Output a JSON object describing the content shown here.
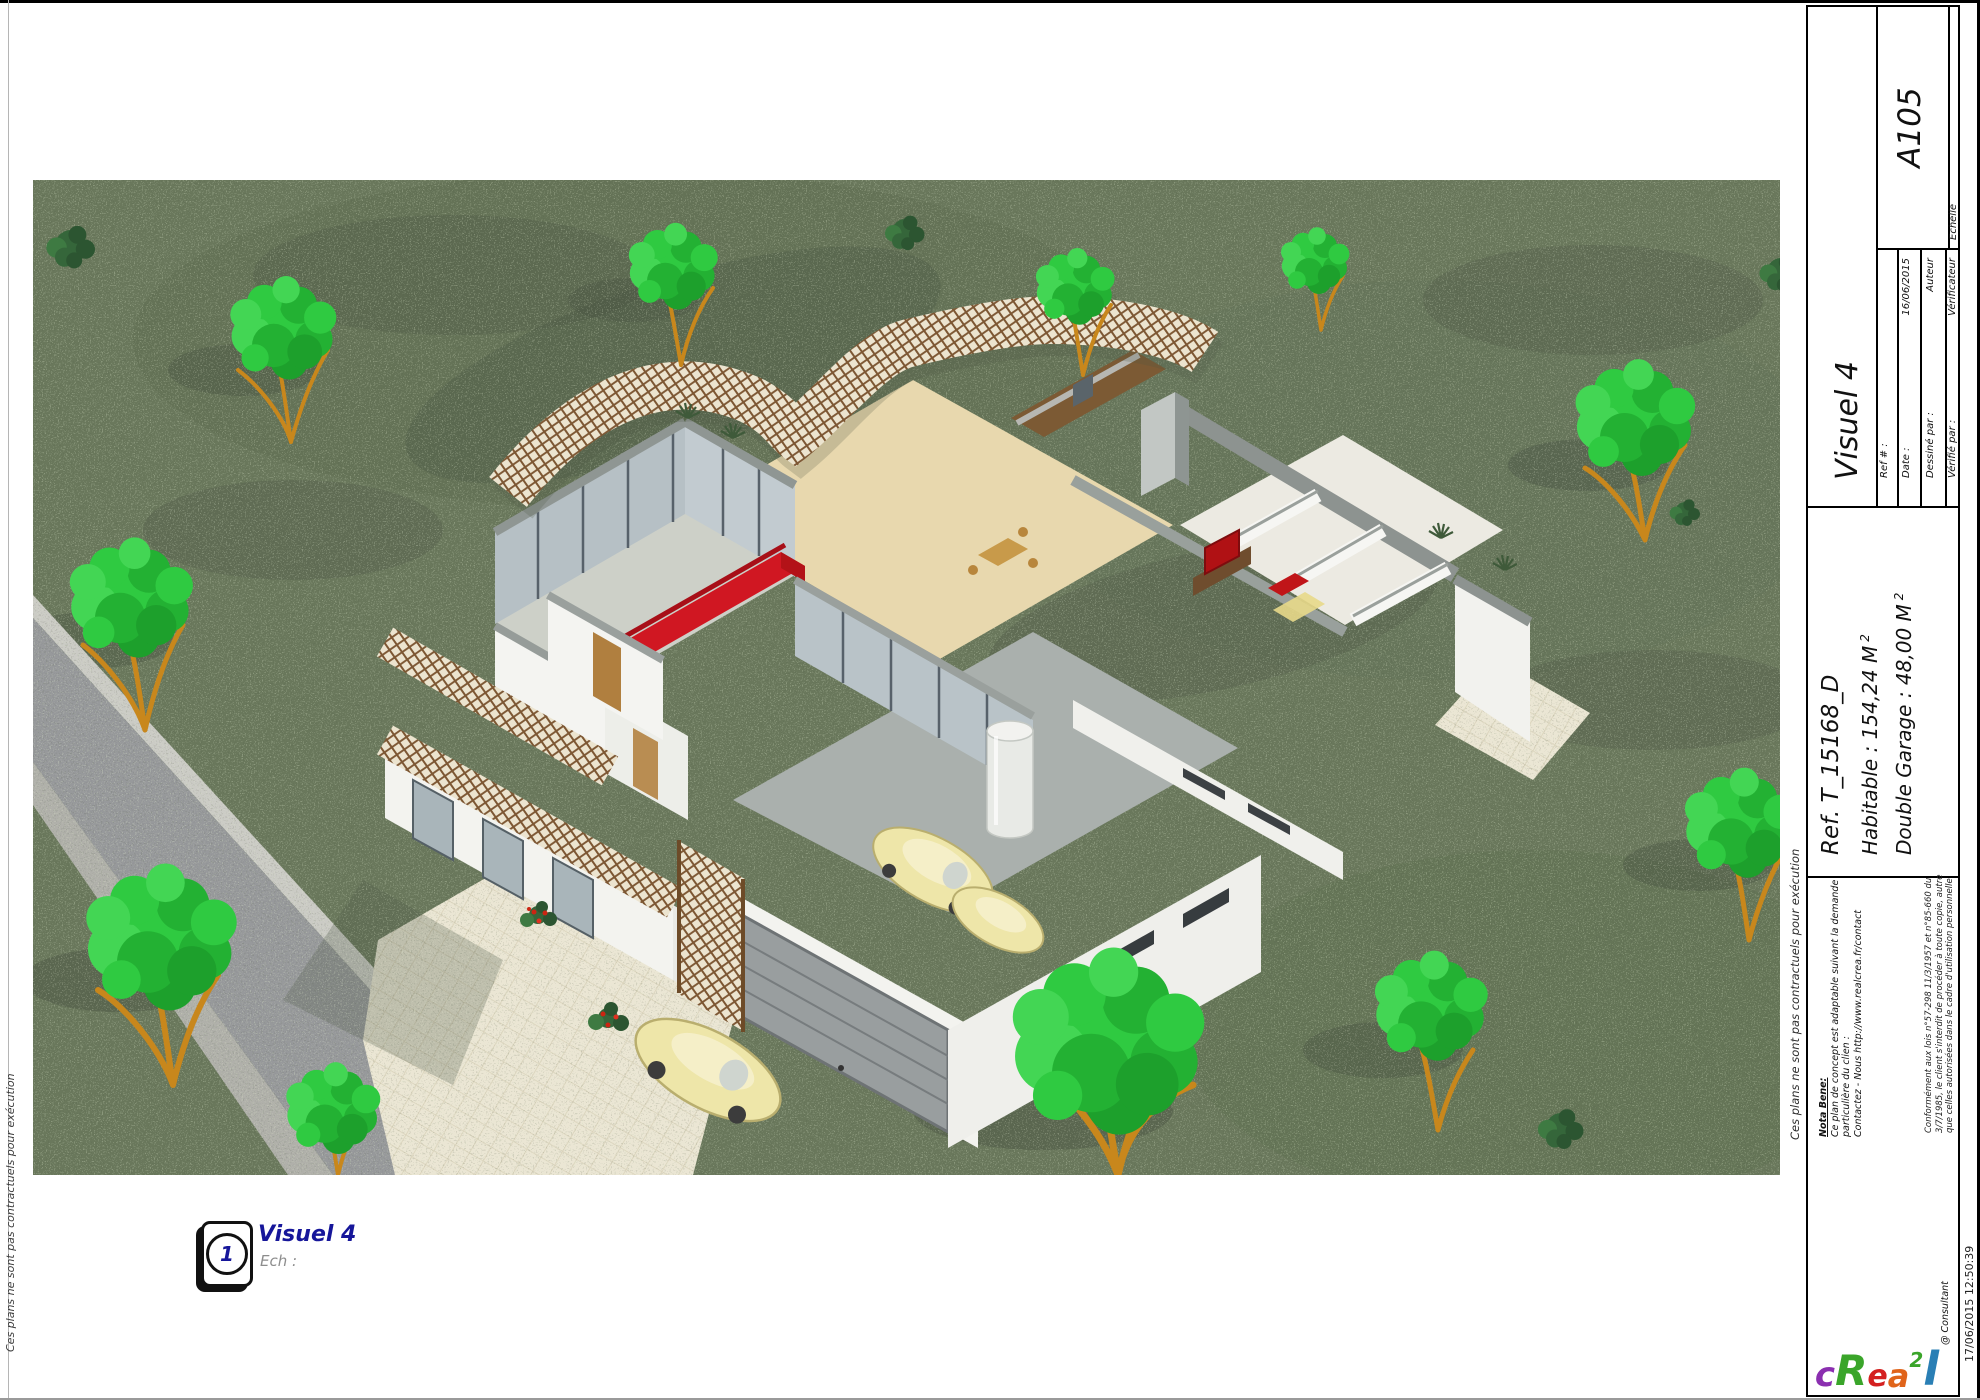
{
  "sheet": {
    "code": "A105",
    "view_title": "Visuel 4",
    "disclaimer": "Ces plans ne sont pas contractuels pour exécution",
    "plot_timestamp": "17/06/2015 12:50:39"
  },
  "title_block": {
    "visuel": "Visuel 4",
    "sheet_code": "A105",
    "echelle_label": "Echelle",
    "fields": [
      {
        "label": "Ref # :",
        "value": ""
      },
      {
        "label": "Date :",
        "value": "16/06/2015"
      },
      {
        "label": "Dessiné par :",
        "value": "Auteur"
      },
      {
        "label": "Vérifié par :",
        "value": "Vérificateur"
      }
    ],
    "ref": "Ref. T_15168_D",
    "habitable": "Habitable : 154,24 M",
    "habitable_sup": "2",
    "garage": "Double Garage : 48,00 M",
    "garage_sup": "2",
    "nota_title": "Nota Bene:",
    "nota_line1": "Ce plan de concept est adaptable suivant la demande",
    "nota_line2": "particulière du clien :",
    "nota_line3": "Contactez - Nous http://www.realcrea.fr/contact",
    "legal": [
      "Conformément aux lois n°57-298 11/3/1957 et n°85-660 du",
      "3/7/1985, le client s'interdit de procéder à toute copie, autre",
      "que celles autorisées dans le cadre d'utilisation personnelle"
    ],
    "consultant": "@ Consultant",
    "logo_letters": [
      {
        "ch": "c",
        "color": "#8b2fb0"
      },
      {
        "ch": "R",
        "color": "#3aa52a"
      },
      {
        "ch": "e",
        "color": "#d42020"
      },
      {
        "ch": "a",
        "color": "#e0641a"
      },
      {
        "ch": "2",
        "color": "#3aa52a"
      },
      {
        "ch": "l",
        "color": "#2a7fb5"
      }
    ]
  },
  "figure_label": {
    "number": "1",
    "title": "Visuel 4",
    "subtitle": "Ech :"
  },
  "colors": {
    "navy": "#16169a",
    "grass": "#6a785c",
    "road": "#97999b",
    "lattice_wood": "#7d5733",
    "sofa_red": "#d01722",
    "tv_red": "#b01114",
    "car_cream": "#eee6a9",
    "tree_green": "#2fca41",
    "branch_orange": "#c8871c",
    "wall_white": "#f4f4f1",
    "wall_top_gray": "#9aa09d"
  }
}
